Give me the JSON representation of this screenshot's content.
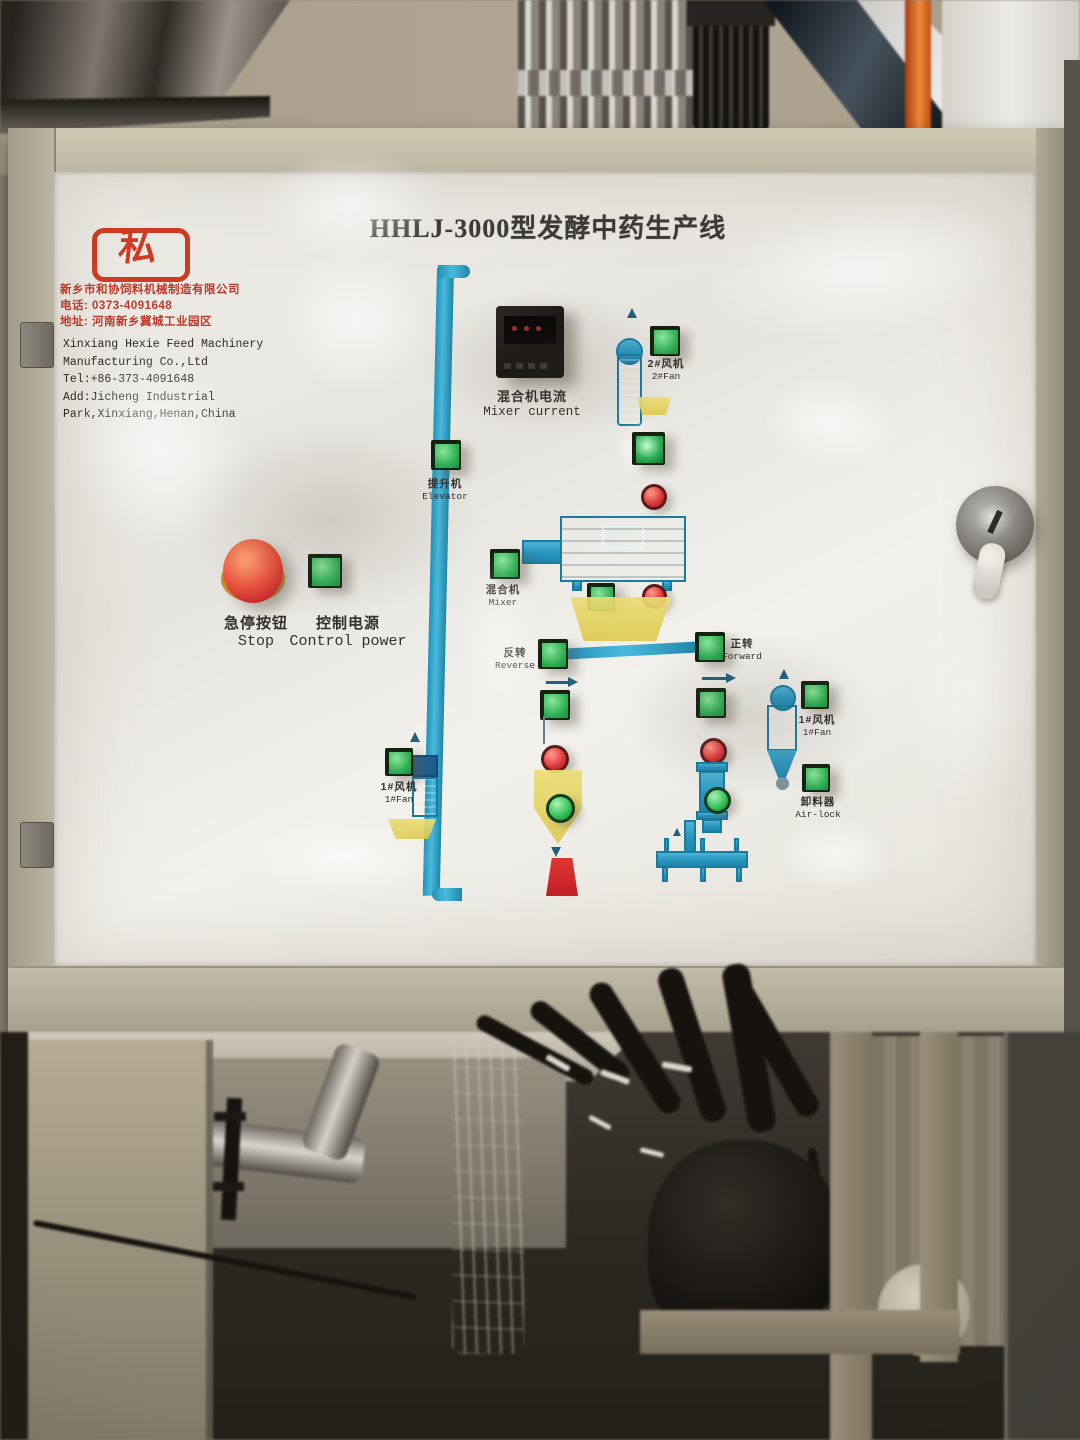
{
  "panel": {
    "title": "HHLJ-3000型发酵中药生产线",
    "logo": {
      "glyph": "私"
    },
    "company": {
      "cn": [
        "新乡市和协饲料机械制造有限公司",
        "电话: 0373-4091648",
        "地址: 河南新乡冀城工业园区"
      ],
      "en": [
        "Xinxiang Hexie Feed Machinery",
        "Manufacturing Co.,Ltd",
        "Tel:+86-373-4091648",
        "Add:Jicheng Industrial",
        "Park,Xinxiang,Henan,China"
      ]
    },
    "controls": {
      "stop": {
        "cn": "急停按钮",
        "en": "Stop"
      },
      "power": {
        "cn": "控制电源",
        "en": "Control power"
      },
      "elevator": {
        "cn": "提升机",
        "en": "Elevator"
      },
      "mixer_current": {
        "cn": "混合机电流",
        "en": "Mixer current"
      },
      "fan2": {
        "cn": "2#风机",
        "en": "2#Fan"
      },
      "mixer": {
        "cn": "混合机",
        "en": "Mixer"
      },
      "reverse": {
        "cn": "反转",
        "en": "Reverse"
      },
      "forward": {
        "cn": "正转",
        "en": "Forward"
      },
      "fan1_left": {
        "cn": "1#风机",
        "en": "1#Fan"
      },
      "fan1_right": {
        "cn": "1#风机",
        "en": "1#Fan"
      },
      "airlock": {
        "cn": "卸料器",
        "en": "Air-lock"
      }
    },
    "colors": {
      "button_green": "#2fae54",
      "indicator_red": "#e03a3a",
      "indicator_green": "#35c45a",
      "line_blue": "#2ea7cc",
      "hopper_yellow": "#e8d96e",
      "estop_red": "#e6503e",
      "brand_red": "#c0392b",
      "cabinet_beige": "#b5ae9a"
    }
  }
}
